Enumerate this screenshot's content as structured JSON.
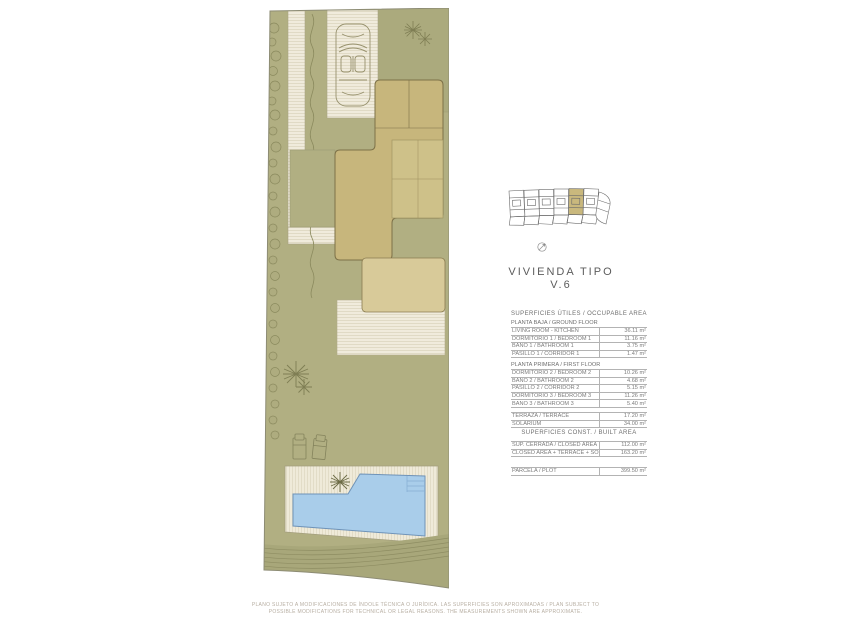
{
  "page": {
    "title_line1": "VIVIENDA TIPO",
    "title_line2": "V.6",
    "disclaimer_line1": "PLANO SUJETO A MODIFICACIONES DE ÍNDOLE TÉCNICA O JURÍDICA. LAS SUPERFICIES SON APROXIMADAS / PLAN SUBJECT TO",
    "disclaimer_line2": "POSSIBLE MODIFICATIONS FOR TECHNICAL OR LEGAL REASONS. THE MEASUREMENTS SHOWN ARE APPROXIMATE."
  },
  "key_plan": {
    "units_count": 6,
    "highlighted_unit": "V.6"
  },
  "areas": {
    "useful_header": "SUPERFICIES ÚTILES / OCCUPABLE AREA",
    "ground_floor": {
      "header": "PLANTA BAJA / GROUND FLOOR",
      "rows": [
        {
          "label": "LIVING ROOM - KITCHEN",
          "value": "36.11 m²"
        },
        {
          "label": "DORMITORIO 1 / BEDROOM 1",
          "value": "11.16 m²"
        },
        {
          "label": "BAÑO 1 / BATHROOM 1",
          "value": "3.75 m²"
        },
        {
          "label": "PASILLO 1 / CORRIDOR 1",
          "value": "1.47 m²"
        }
      ]
    },
    "first_floor": {
      "header": "PLANTA PRIMERA / FIRST FLOOR",
      "rows": [
        {
          "label": "DORMITORIO 2 / BEDROOM 2",
          "value": "10.26 m²"
        },
        {
          "label": "BAÑO 2 / BATHROOM 2",
          "value": "4.68 m²"
        },
        {
          "label": "PASILLO 2 / CORRIDOR 2",
          "value": "5.15 m²"
        },
        {
          "label": "DORMITORIO 3 / BEDROOM 3",
          "value": "11.26 m²"
        },
        {
          "label": "BAÑO 3 / BATHROOM 3",
          "value": "5.40 m²"
        }
      ]
    },
    "outdoor_rows": [
      {
        "label": "TERRAZA / TERRACE",
        "value": "17.20 m²"
      },
      {
        "label": "SOLARIUM",
        "value": "34.00 m²"
      }
    ],
    "built_header": "SUPERFICIES CONST. / BUILT AREA",
    "built_rows": [
      {
        "label": "SUP. CERRADA / CLOSED AREA",
        "value": "112.00 m²"
      },
      {
        "label": "CLOSED AREA + TERRACE + SOLARIUM",
        "value": "163.20 m²"
      }
    ],
    "plot_rows": [
      {
        "label": "PARCELA / PLOT",
        "value": "399.50 m²"
      }
    ]
  },
  "colors": {
    "lawn": "#b1af82",
    "building": "#c7b67c",
    "terrace_slab": "#d8ca99",
    "deck": "#f0ebdc",
    "pool": "#a9cdea",
    "highlight_unit": "#c9b87d"
  }
}
